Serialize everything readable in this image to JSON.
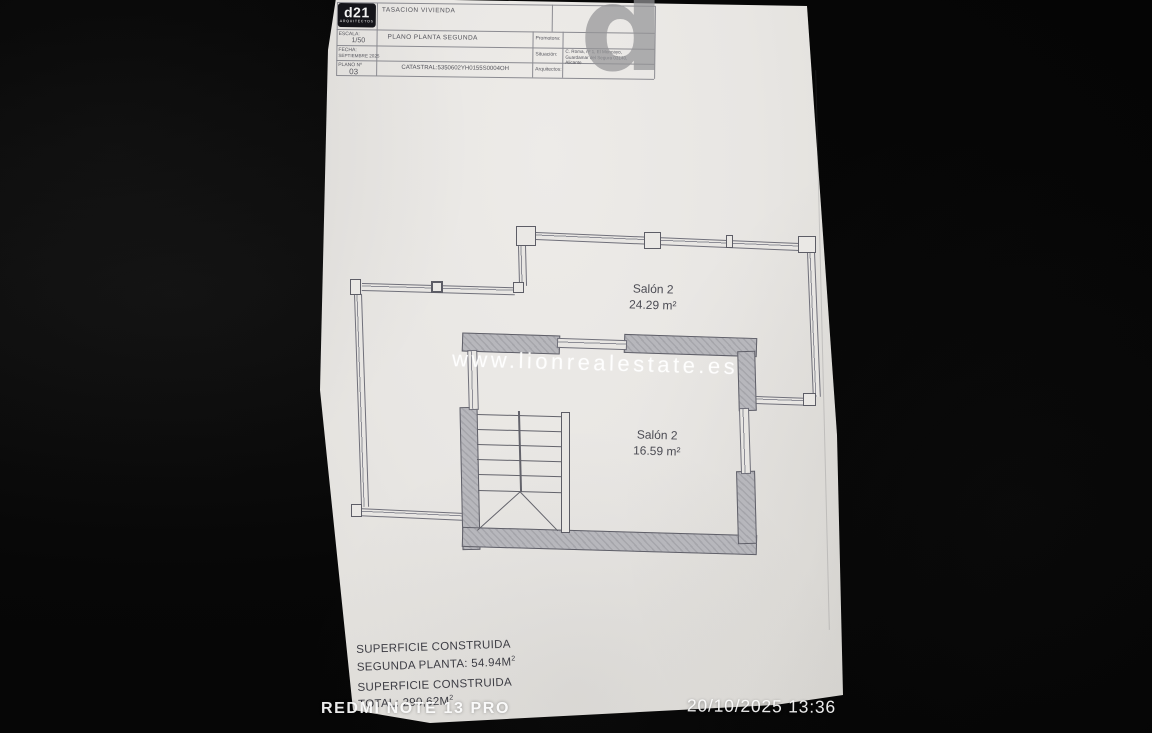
{
  "photo": {
    "camera_watermark": "REDMI NOTE 13 PRO",
    "timestamp": "20/10/2025  13:36"
  },
  "title_block": {
    "logo_text": "d21",
    "logo_subtext": "ARQUITECTOS",
    "doc_title": "TASACION VIVIENDA",
    "escala_label": "ESCALA:",
    "escala_value": "1/50",
    "plano_title": "PLANO PLANTA SEGUNDA",
    "fecha_label": "FECHA:",
    "fecha_value": "SEPTIEMBRE 2025",
    "plano_num_label": "PLANO Nº",
    "plano_num_value": "03",
    "catastral": "CATASTRAL:5350602YH0155S0004OH",
    "promotora_label": "Promotora:",
    "situacion_label": "Situación:",
    "situacion_lines": [
      "C. Roma, nº 1, El Moncayo,",
      "Guardamar del Segura 03140,",
      "Alicante"
    ],
    "arquitectos_label": "Arquitectos:",
    "watermark_letter": "d"
  },
  "plan": {
    "rooms": [
      {
        "name": "Salón 2",
        "area": "24.29 m²"
      },
      {
        "name": "Salón 2",
        "area": "16.59 m²"
      }
    ],
    "watermark": "www.lionrealestate.es"
  },
  "summary": {
    "line1": "SUPERFICIE CONSTRUIDA",
    "line2_prefix": "SEGUNDA PLANTA: 54.94M",
    "line3": "SUPERFICIE CONSTRUIDA",
    "line4_prefix": "TOTAL: 290,62M",
    "sup": "2"
  }
}
